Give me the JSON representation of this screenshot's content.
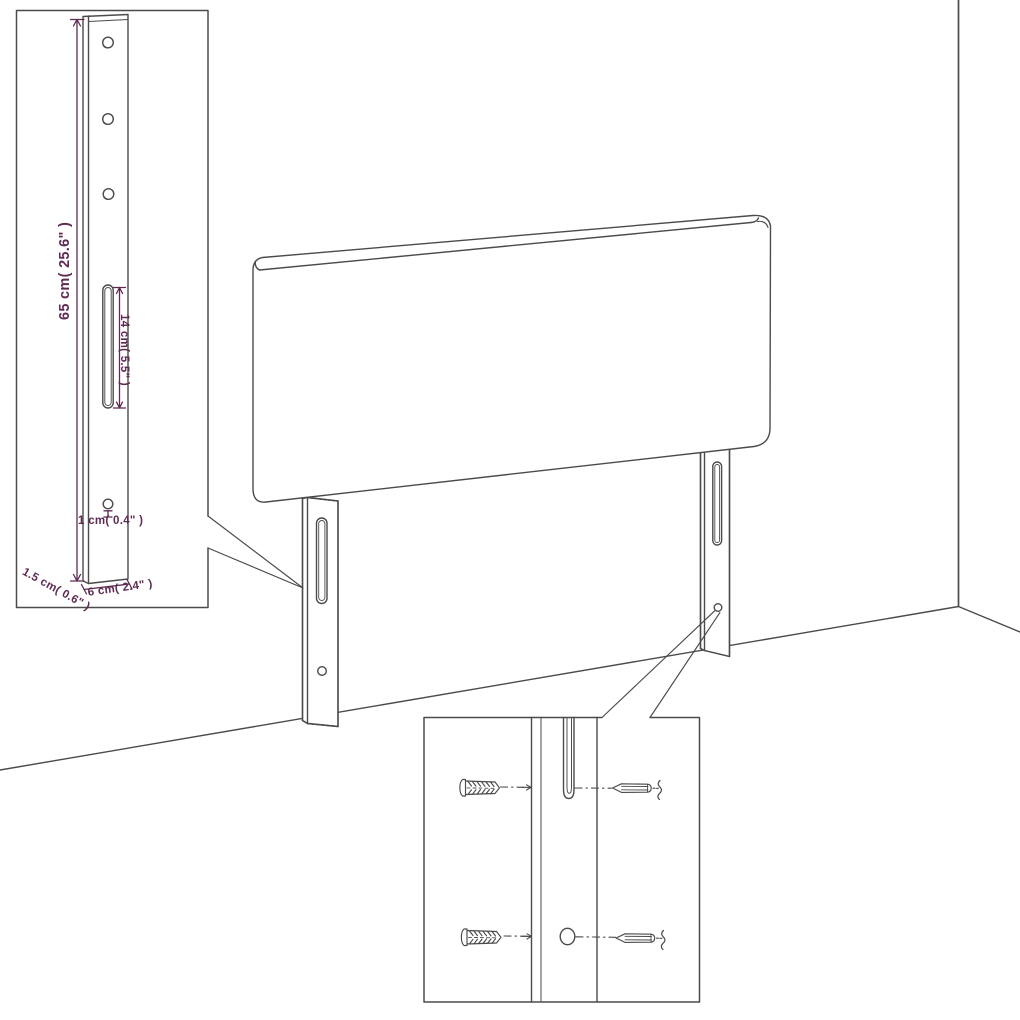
{
  "title": "Headboard assembly dimension diagram",
  "colors": {
    "line": "#4b4b4b",
    "dimension_text": "#5e2b52",
    "background": "#ffffff"
  },
  "leg_detail_inset": {
    "height_label": "65 cm( 25.6\" )",
    "slot_label": "14 cm( 5.5\" )",
    "hole_label": "1 cm( 0.4\" )",
    "depth_label": "1.5 cm( 0.6\" )",
    "width_label": "6 cm( 2.4\" )"
  },
  "hardware_inset": {
    "top_row": [
      "wall-plug-anchor",
      "mounting-slot",
      "screw"
    ],
    "bottom_row": [
      "wall-plug-anchor",
      "mounting-hole",
      "screw"
    ]
  }
}
